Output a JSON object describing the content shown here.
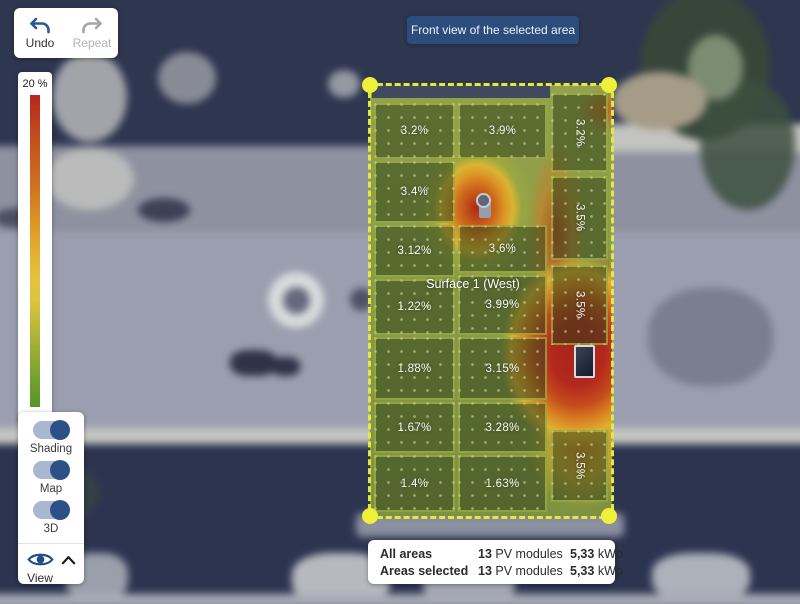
{
  "toolbar": {
    "undo_label": "Undo",
    "repeat_label": "Repeat"
  },
  "view_badge": {
    "text": "Front view of the selected area"
  },
  "legend": {
    "max_label": "20 %"
  },
  "layers_panel": {
    "toggles": [
      {
        "label": "Shading",
        "on": true
      },
      {
        "label": "Map",
        "on": true
      },
      {
        "label": "3D",
        "on": true
      }
    ],
    "view_label": "View"
  },
  "heatmap": {
    "surface_label": "Surface 1 (West)",
    "modules": [
      {
        "label": "3.2%"
      },
      {
        "label": "3.4%"
      },
      {
        "label": "3.12%"
      },
      {
        "label": "1.22%"
      },
      {
        "label": "1.88%"
      },
      {
        "label": "1.67%"
      },
      {
        "label": "1.4%"
      },
      {
        "label": "3.9%"
      },
      {
        "label": "3.6%"
      },
      {
        "label": "3.99%"
      },
      {
        "label": "3.15%"
      },
      {
        "label": "3.28%"
      },
      {
        "label": "1.63%"
      },
      {
        "label": "3.2%"
      },
      {
        "label": "3.5%"
      },
      {
        "label": "3.5%"
      },
      {
        "label": "3.5%"
      }
    ]
  },
  "summary": {
    "rows": [
      {
        "label": "All areas",
        "module_count": "13",
        "module_unit": "PV modules",
        "power": "5,33",
        "power_unit": "kWp"
      },
      {
        "label": "Areas selected",
        "module_count": "13",
        "module_unit": "PV modules",
        "power": "5,33",
        "power_unit": "kWp"
      }
    ]
  },
  "colors": {
    "accent_blue": "#2c4d7c",
    "toggle_on": "#2d5187",
    "selection_yellow": "#e9ec3e",
    "legend_top": "#b5271b",
    "legend_bottom": "#55942b"
  }
}
